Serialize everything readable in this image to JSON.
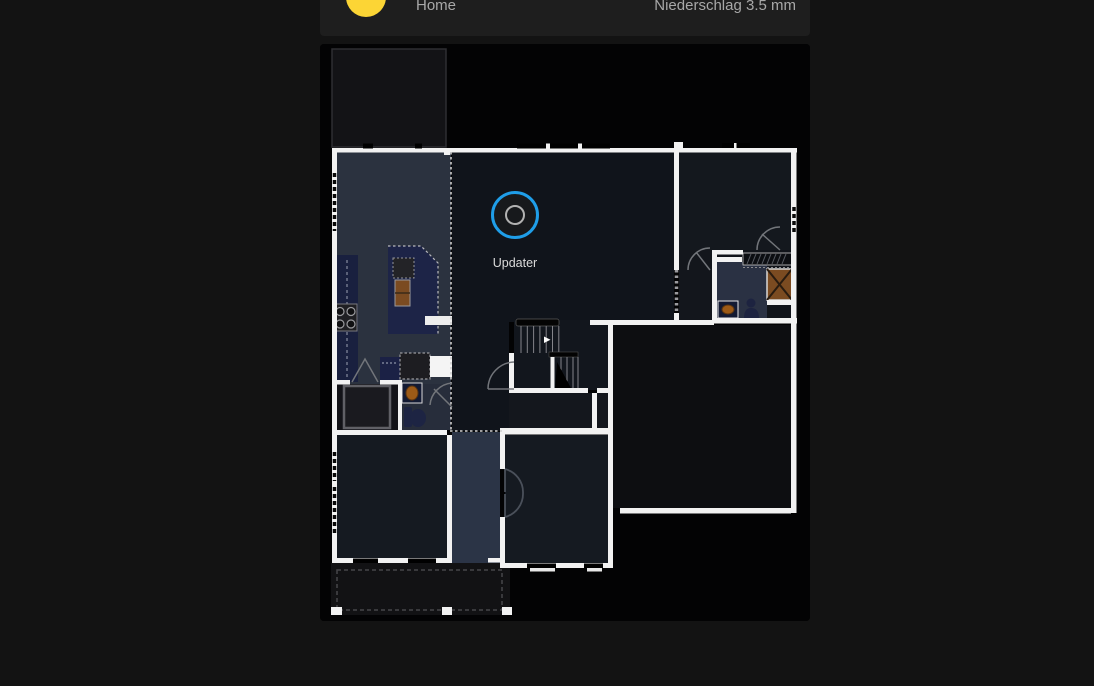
{
  "header": {
    "title": "Home",
    "status": "Niederschlag 3.5 mm",
    "icon": "sun-icon",
    "icon_color": "#fcd535"
  },
  "floorplan": {
    "updater_label": "Updater",
    "updater_ring_color": "#1f9ee9",
    "wall_color": "#f2f2f2",
    "room_colors": {
      "kitchen": "#2b323f",
      "living": "#10141b",
      "bedroom": "#14181e",
      "bathroom": "#2a3143",
      "hallway": "#2b3446",
      "garage": "#0d0e11"
    }
  }
}
